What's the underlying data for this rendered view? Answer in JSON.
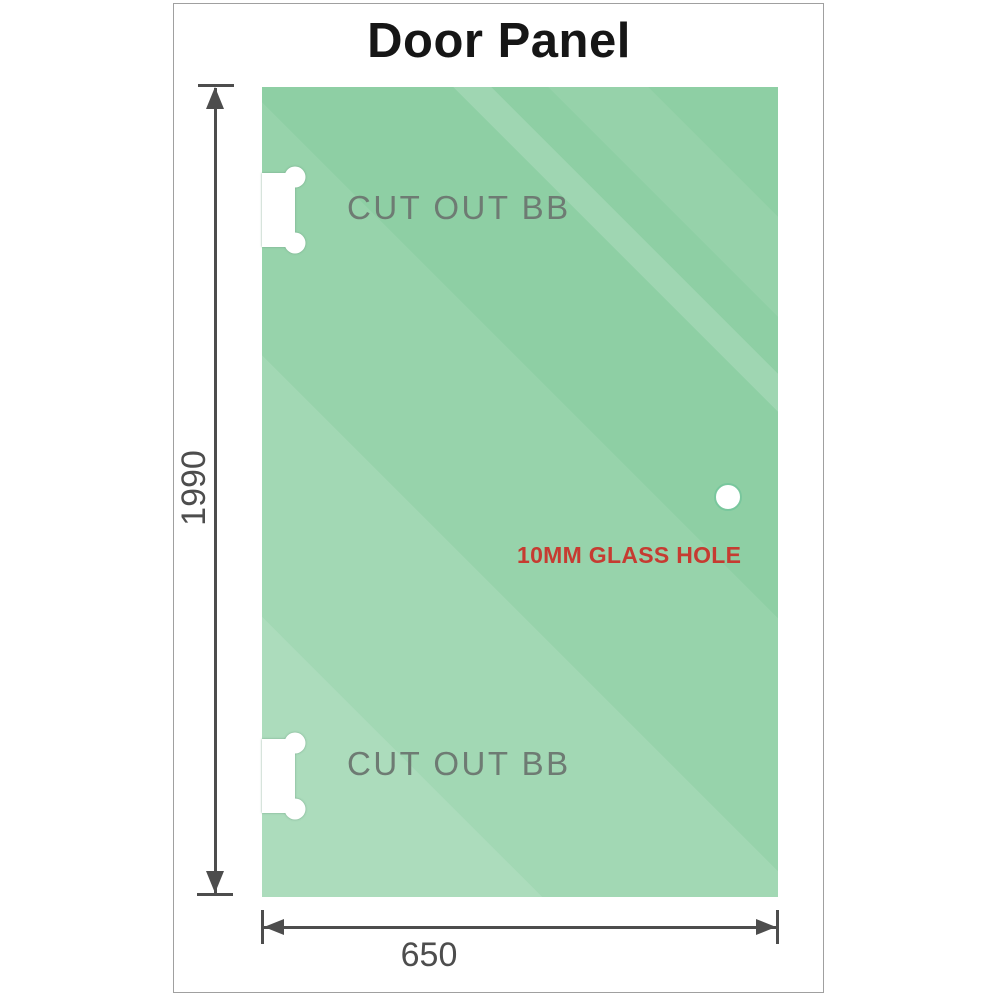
{
  "title": "Door Panel",
  "colors": {
    "panel-green": "#8ecfa4",
    "frame-border": "#a0a0a0",
    "title-color": "#161616",
    "label-gray": "#6e7b73",
    "hole-red": "#c63b31",
    "dim-gray": "#4d4d4d",
    "hole-ring": "#79c79d"
  },
  "panel": {
    "cutouts": [
      {
        "label": "CUT OUT BB"
      },
      {
        "label": "CUT OUT BB"
      }
    ],
    "hole": {
      "label": "10MM GLASS HOLE"
    }
  },
  "dimensions": {
    "height": {
      "value": "1990"
    },
    "width": {
      "value": "650"
    }
  }
}
